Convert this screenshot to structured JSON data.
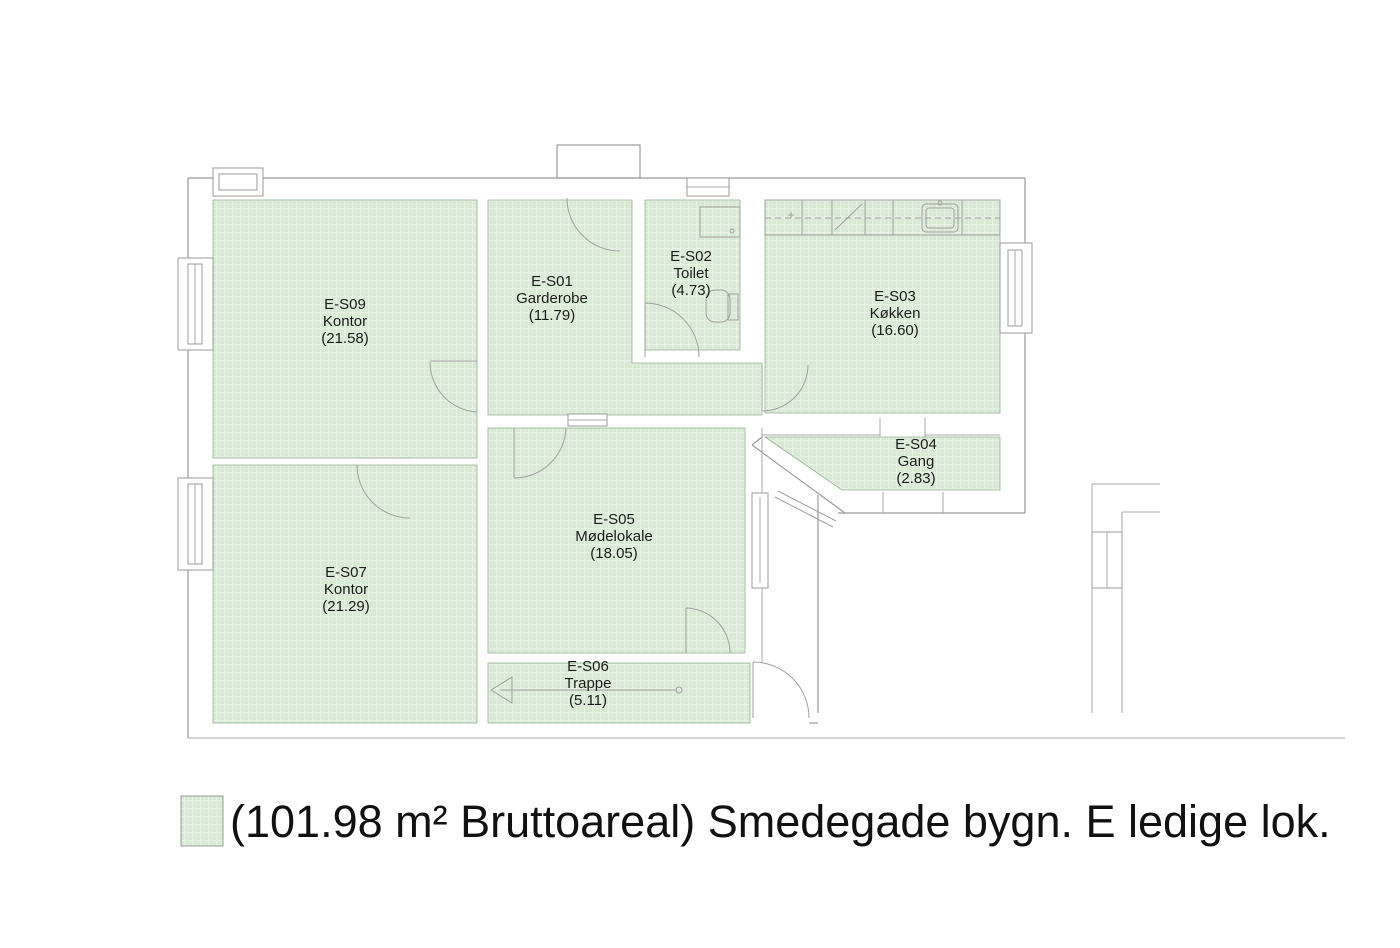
{
  "plan": {
    "rooms": [
      {
        "id": "E-S09",
        "name": "Kontor",
        "area": "(21.58)"
      },
      {
        "id": "E-S01",
        "name": "Garderobe",
        "area": "(11.79)"
      },
      {
        "id": "E-S02",
        "name": "Toilet",
        "area": "(4.73)"
      },
      {
        "id": "E-S03",
        "name": "Køkken",
        "area": "(16.60)"
      },
      {
        "id": "E-S04",
        "name": "Gang",
        "area": "(2.83)"
      },
      {
        "id": "E-S05",
        "name": "Mødelokale",
        "area": "(18.05)"
      },
      {
        "id": "E-S06",
        "name": "Trappe",
        "area": "(5.11)"
      },
      {
        "id": "E-S07",
        "name": "Kontor",
        "area": "(21.29)"
      }
    ],
    "colors": {
      "room_fill": "#d7e8d4",
      "wall_line": "#9b9b9b"
    }
  },
  "legend": {
    "text": "(101.98 m² Bruttoareal) Smedegade bygn. E ledige lok."
  }
}
